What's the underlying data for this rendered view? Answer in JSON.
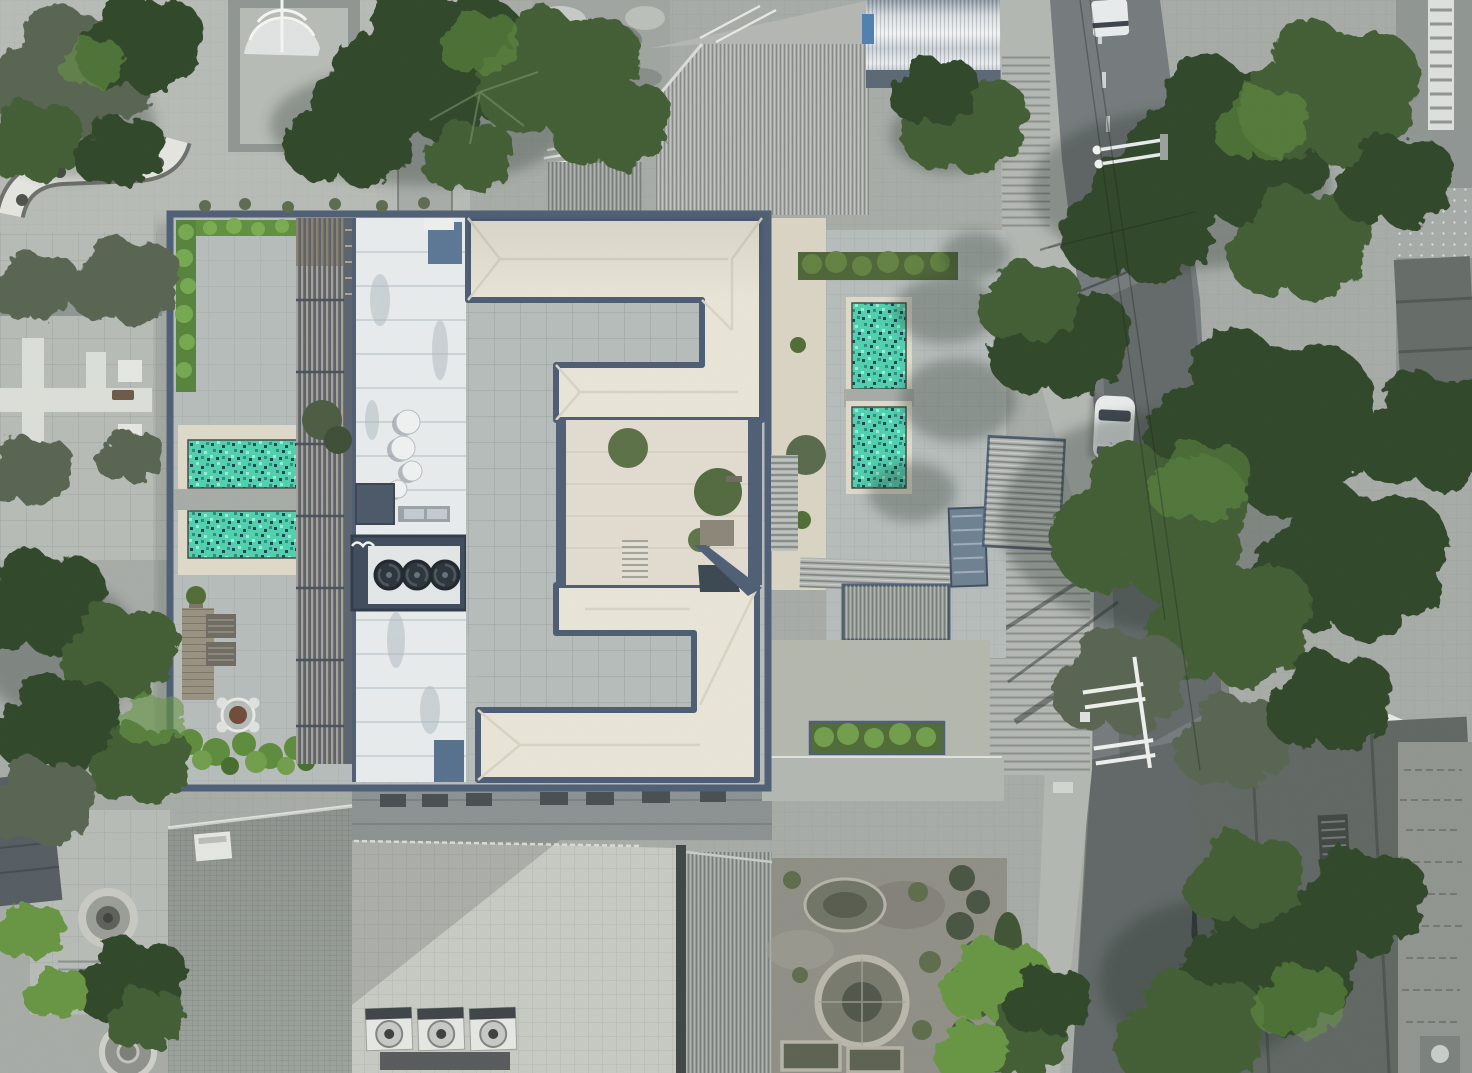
{
  "scene": {
    "type": "aerial-drone-photograph",
    "title": "Top-down aerial view of a modern apartment building with rooftop terraces, turquoise mosaic pools, a tree-lined street and surrounding city rooftops",
    "orientation": "nadir (straight down)",
    "lighting": "bright midday sun, shadows cast toward the west"
  },
  "palette": {
    "concrete_light": "#b7bbb5",
    "concrete_mid": "#a6aba6",
    "concrete_dark": "#8f9590",
    "asphalt": "#747a7b",
    "asphalt_shadow": "#4e5553",
    "sidewalk": "#b3b7b2",
    "navy_trim": "#4d5d73",
    "navy_dark": "#39465a",
    "roof_cream": "#e9e5d7",
    "roof_cream_shade": "#d9d4c2",
    "court_gray": "#b6bcba",
    "court_inner": "#e1dccf",
    "metal_white": "#e8eced",
    "pool_base": "#4fd0ae",
    "pool_dark": "#17444e",
    "pool_mid": "#2a8f7e",
    "pool_light": "#93f0d4",
    "pool_deck": "#ded9c8",
    "pergola_base": "#59626b",
    "pergola_slat": "#a7a093",
    "pergola_wood": "#8d7f68",
    "wood_deck": "#97907f",
    "brick_roof": "#9ba19b",
    "terrace_tile": "#c7cac2",
    "ribbed_roof": "#949a93",
    "soil": "#8f8e85",
    "hedge_green": "#5f8f3d",
    "foliage_dark": "#2e4526",
    "foliage_mid": "#3f5c30",
    "foliage_bright": "#669541",
    "foliage_olive": "#57644f",
    "tarp_blue": "#6c8091",
    "car_white": "#e9ecec",
    "car_blue": "#7d939c"
  },
  "objects": {
    "main_building": {
      "roof_shape": "white hipped roof wings forming an E-shape around gray tiled courtyards",
      "trim": "blue-gray fascia and parapet walls",
      "inner_courtyard": "cream paved patio with potted trees, stairs and a dark skylight"
    },
    "pools": {
      "count": 4,
      "left_terrace_pools": 2,
      "right_terrace_pools": 2,
      "finish": "turquoise mosaic tile with cream coping"
    },
    "rooftop_equipment": {
      "satellite_dishes": 4,
      "rooftop_fan_bank_fans": 3,
      "lower_roof_ac_units": 3,
      "pergola": "slatted louver canopy over west terrace",
      "skylights_blue": 2
    },
    "furniture": {
      "round_dining_table_with_chairs": 1,
      "sun_loungers": 2
    },
    "vehicles": {
      "white_car_on_street": 1,
      "dark_car_under_trees": 1,
      "blue_gray_sedan_bottom": 1,
      "white_truck_top_edge": 1,
      "white_car_roof_far_right": 1
    },
    "street": {
      "position": "runs vertically along the right side",
      "features": [
        "lane dashes",
        "stepped sidewalk",
        "street lamp arms",
        "power pole with white crossarms",
        "overhead wire shadows"
      ]
    },
    "landscape": {
      "street_trees": "large green canopies along the east street",
      "rooftop_hedges": 3,
      "garden_south": [
        "circular flower bed",
        "oval bed",
        "two rectangular beds",
        "hedge row"
      ],
      "park_northwest": [
        "white dome canopy",
        "pebble path with planting pits",
        "large pine"
      ],
      "plaza_west": "tiled plaza with white cross-shaped planter paths",
      "garden_southwest": [
        "circular fountain",
        "stone medallion path"
      ]
    },
    "neighborhood": {
      "metallic_barrel_roof_top": 1,
      "corrugated_roofs_top": 2,
      "brick_tiled_roof_bottom_left": 1,
      "lower_terrace_bottom": "large tiled terrace with AC units",
      "east_edge_buildings": "facades with balcony rail and vent boxes"
    }
  }
}
